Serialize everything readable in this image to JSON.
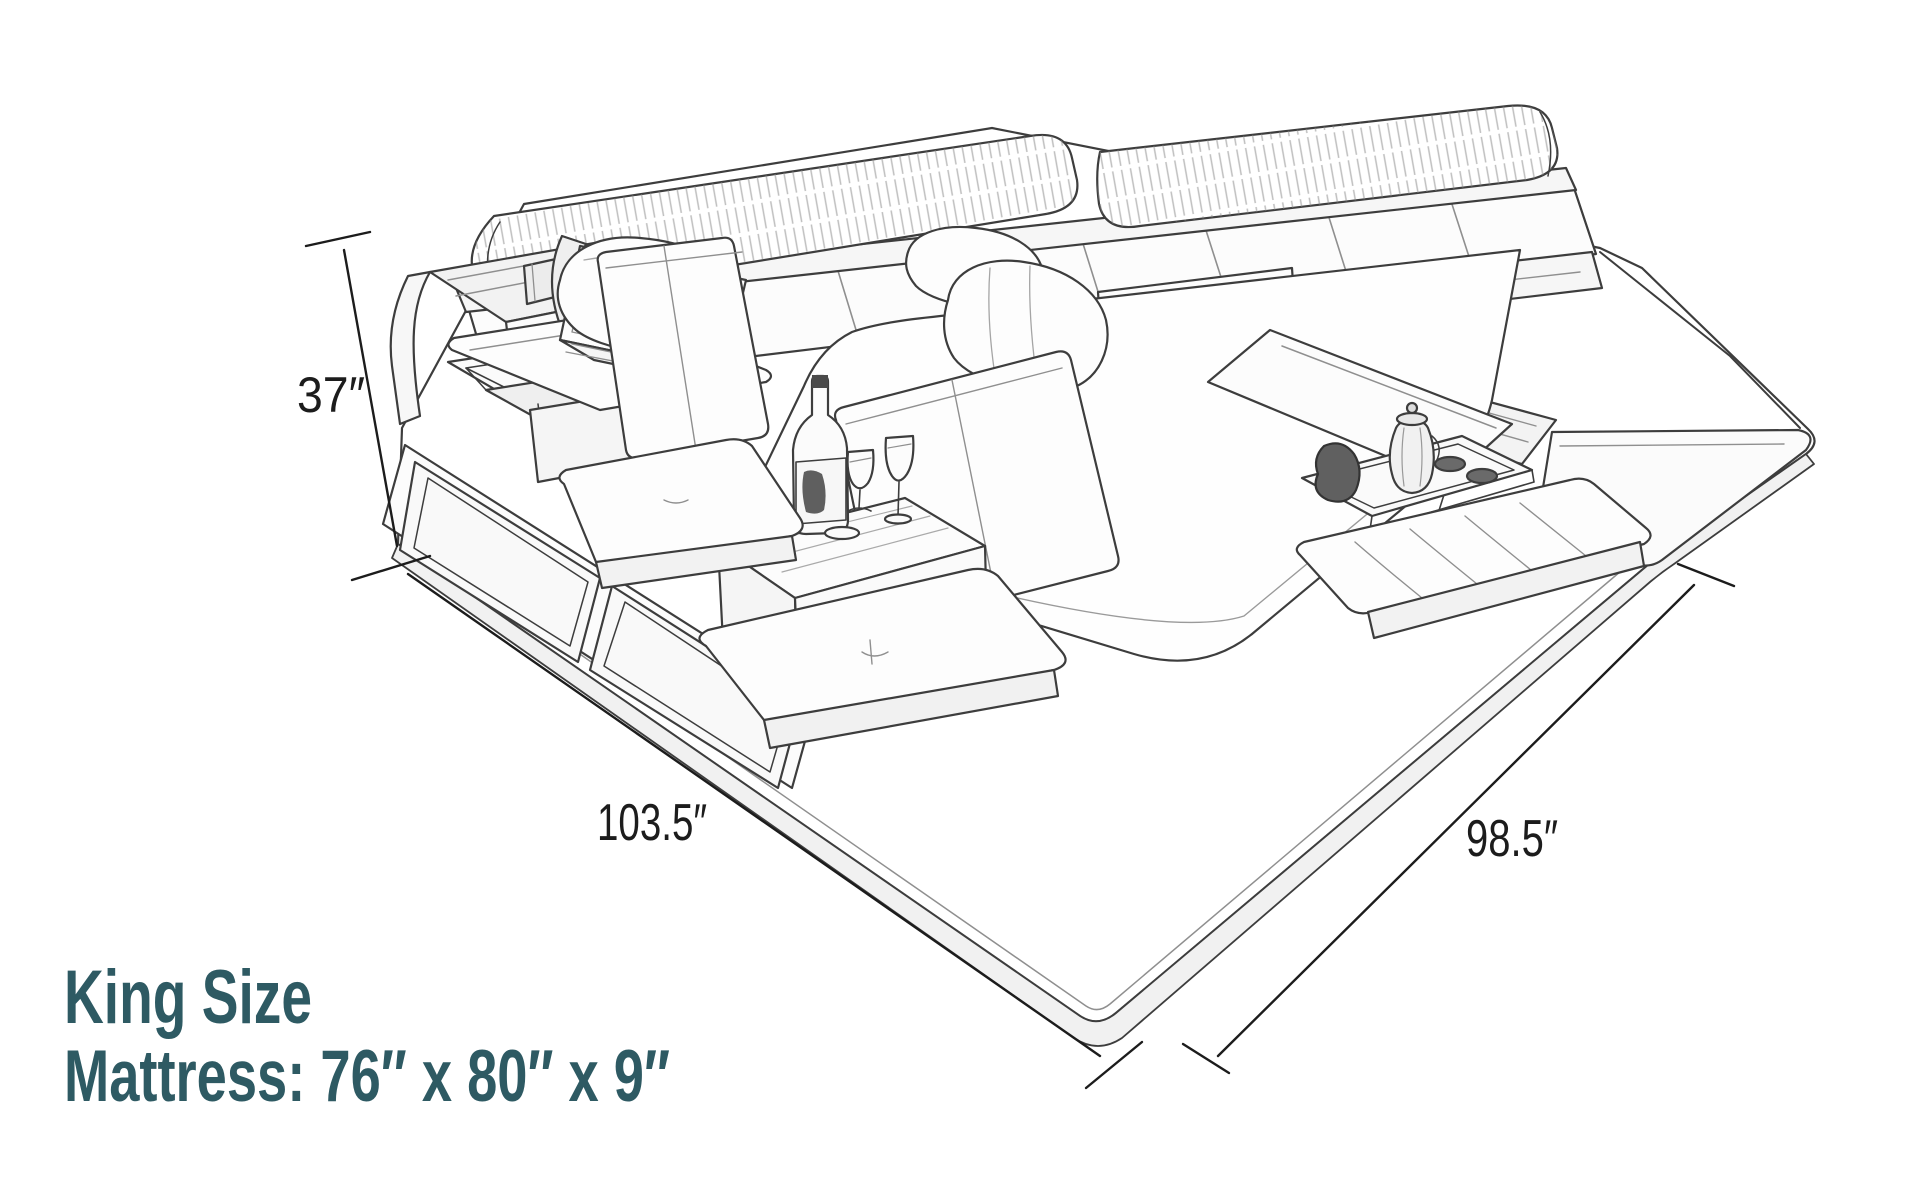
{
  "canvas": {
    "width": 1920,
    "height": 1200,
    "background": "#ffffff"
  },
  "illustration": {
    "stroke_color": "#3d3d3d",
    "detail_color": "#8f8f8f",
    "fill_light": "#f4f4f4",
    "parts": [
      "headboard",
      "headrest-cushions",
      "storage-console",
      "laptop",
      "lift-top-storage",
      "side-table",
      "wine-bottle",
      "wine-glasses",
      "seat-backrests",
      "seat-cushions",
      "mattress",
      "pillows",
      "storage-flap",
      "serving-tray",
      "coffee-pot",
      "foot-bench",
      "platform-base"
    ]
  },
  "dimensions": {
    "text_color": "#1c1c1c",
    "height": {
      "label": "37″"
    },
    "length": {
      "label": "103.5″"
    },
    "width": {
      "label": "98.5″"
    }
  },
  "caption": {
    "color": "#2e5a63",
    "title": "King Size",
    "spec": "Mattress: 76″ x 80″ x 9″"
  }
}
